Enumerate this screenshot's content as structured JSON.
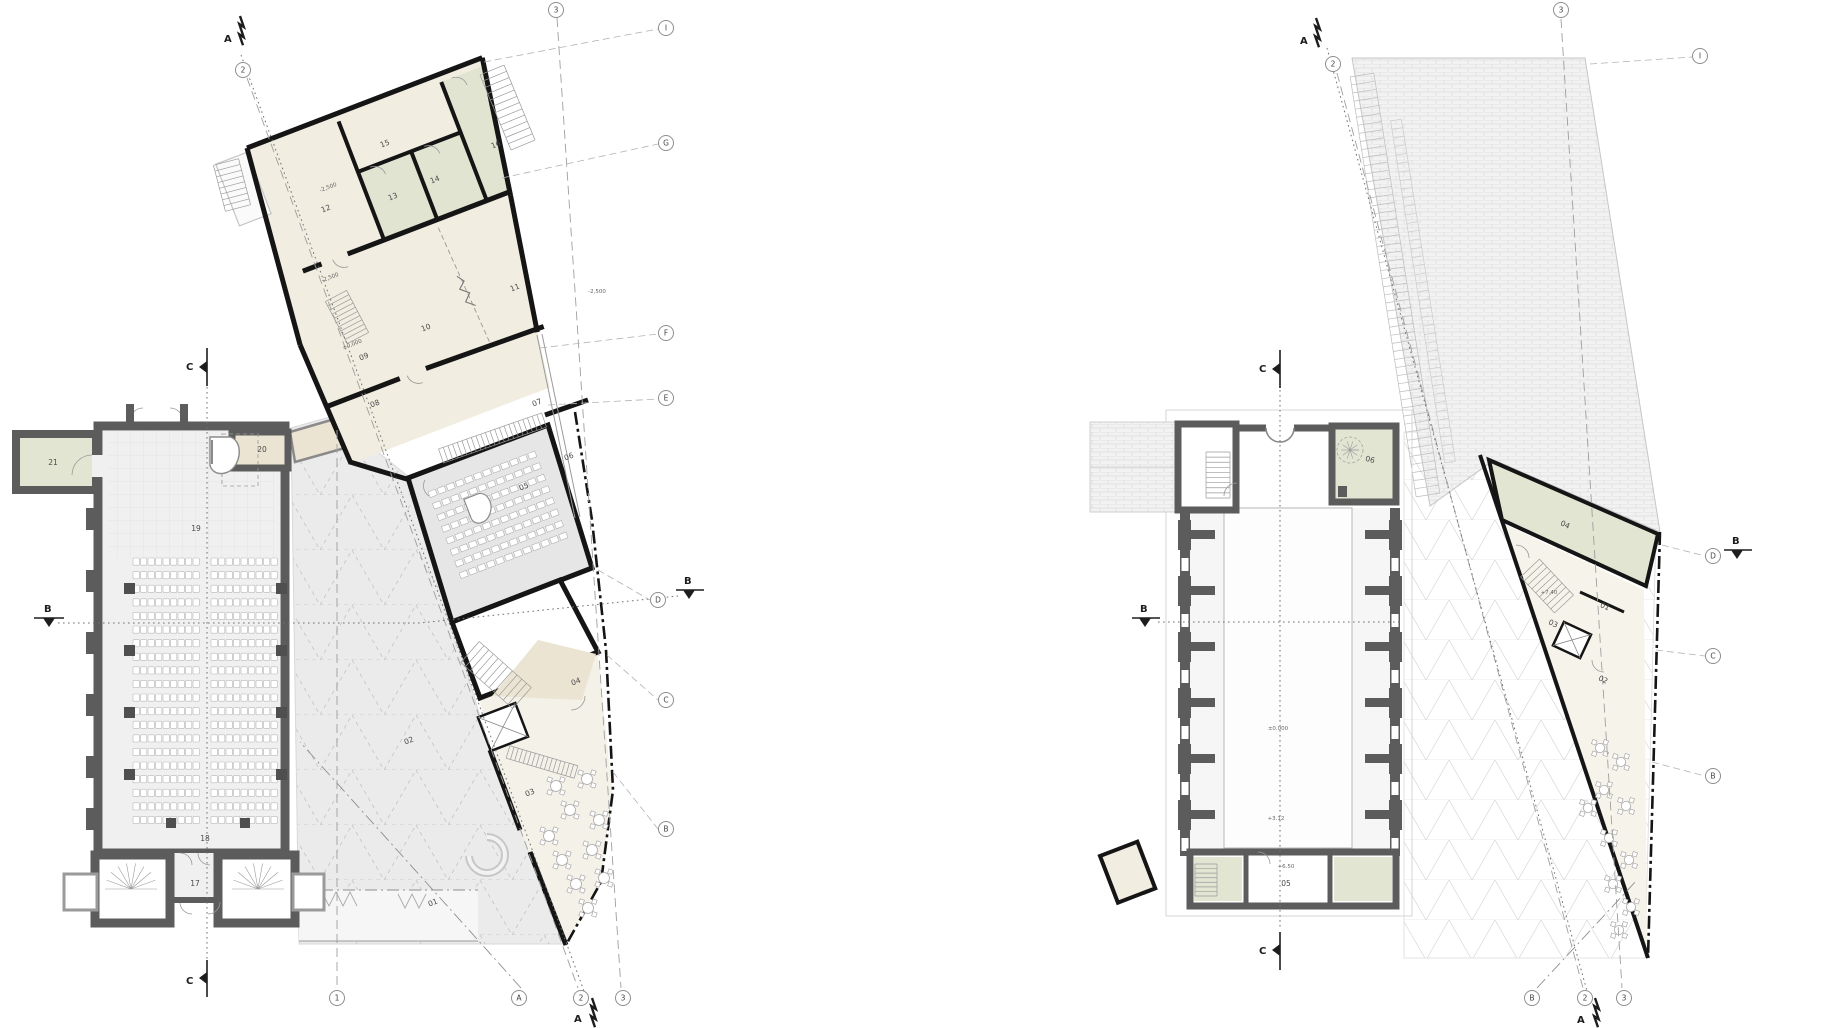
{
  "left_plan": {
    "rooms": {
      "r01": "01",
      "r02": "02",
      "r03": "03",
      "r04": "04",
      "r05": "05",
      "r06": "06",
      "r07": "07",
      "r08": "08",
      "r09": "09",
      "r10": "10",
      "r11": "11",
      "r12": "12",
      "r13": "13",
      "r14": "14",
      "r15": "15",
      "r16": "16",
      "r17": "17",
      "r18": "18",
      "r19": "19",
      "r20": "20",
      "r21": "21"
    },
    "levels": {
      "room12": "-2,500",
      "stair": "-2,500",
      "hall": "±0,000",
      "terrace": "-2,500"
    },
    "axes": {
      "top_a": "A",
      "top_2": "2",
      "top_3": "3",
      "bottom_1": "1",
      "bottom_a": "A",
      "bottom_2": "2",
      "bottom_a_section": "A",
      "bottom_3": "3"
    },
    "elevation_markers": {
      "i": "I",
      "g": "G",
      "f": "F",
      "e": "E",
      "d": "D",
      "c": "C",
      "b": "B"
    },
    "sections": {
      "b_left": "B",
      "b_right": "B",
      "c_top": "C",
      "c_bottom": "C"
    }
  },
  "right_plan": {
    "rooms": {
      "r01": "01",
      "r02": "02",
      "r03": "03",
      "r04": "04",
      "r05": "05",
      "r06": "06"
    },
    "levels": {
      "nave": "±0.000",
      "gallery": "+3.12",
      "room05": "+6.50",
      "wing": "+7.40"
    },
    "axes": {
      "top_a": "A",
      "top_2": "2",
      "top_3": "3",
      "bottom_b": "B",
      "bottom_2": "2",
      "bottom_a": "A",
      "bottom_3": "3"
    },
    "elevation_markers": {
      "i": "I",
      "d": "D",
      "c": "C",
      "b": "B"
    },
    "sections": {
      "b_left": "B",
      "b_right": "B",
      "c_top": "C",
      "c_bottom": "C"
    }
  }
}
